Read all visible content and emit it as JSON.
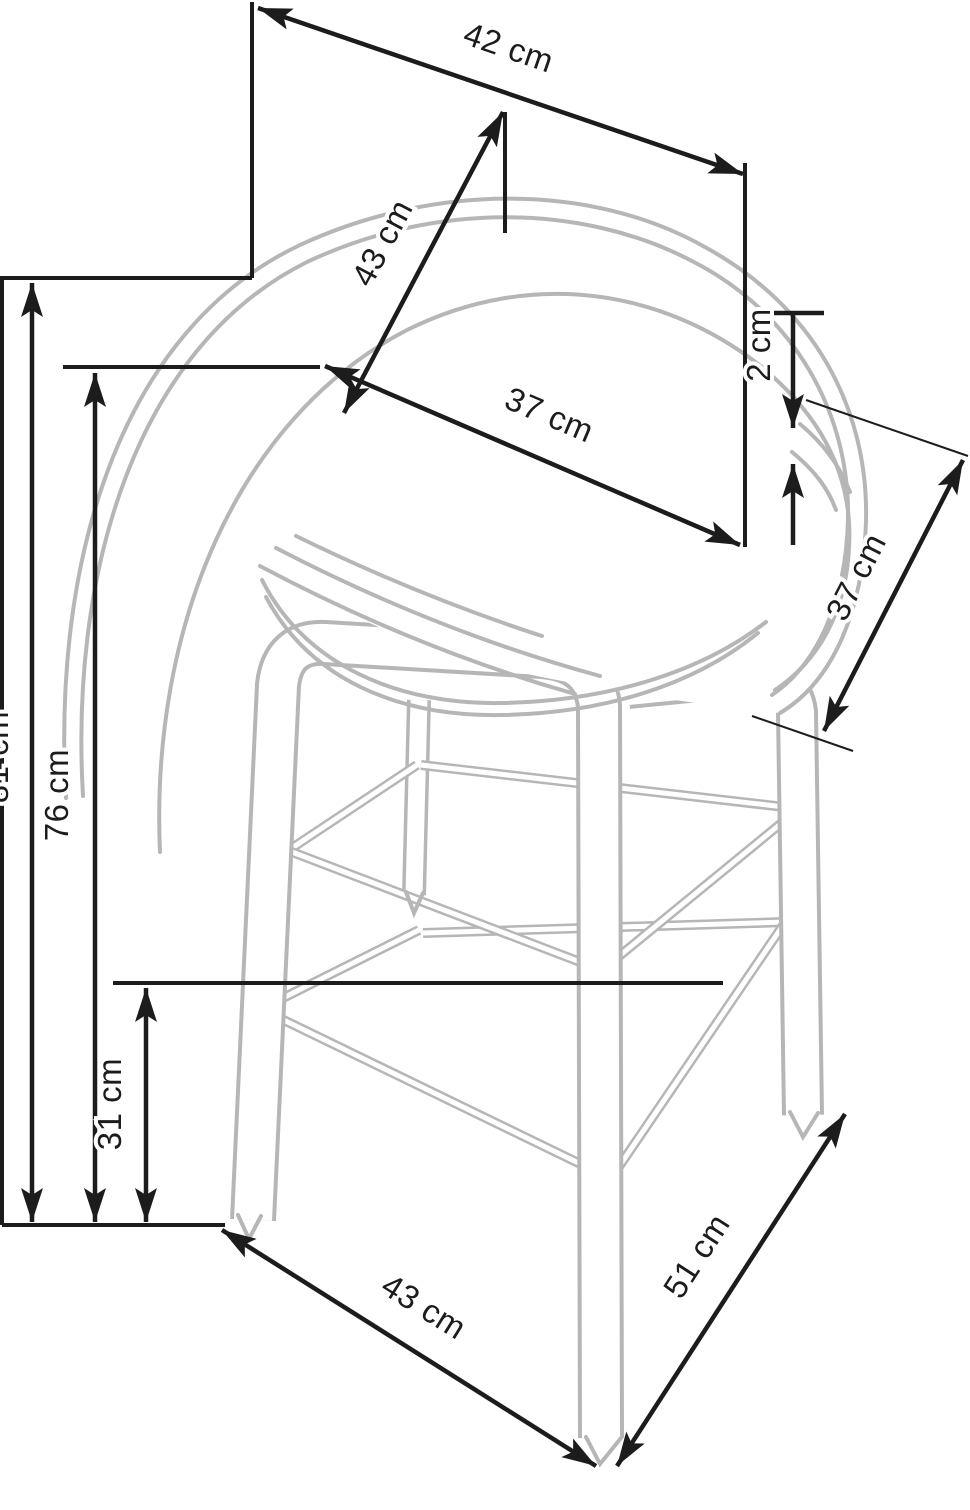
{
  "diagram": {
    "title": "bar stool dimension drawing",
    "unit": "cm",
    "colors": {
      "dimension_lines": "#1c1c1c",
      "stool_outline": "#b6b6b6",
      "background": "#ffffff",
      "label_halo": "#ffffff"
    },
    "dimensions": [
      {
        "id": "seat-top-width",
        "label": "42 cm",
        "value": 42
      },
      {
        "id": "backrest-diagonal",
        "label": "43 cm",
        "value": 43
      },
      {
        "id": "seat-inner-width",
        "label": "37 cm",
        "value": 37
      },
      {
        "id": "rim-thickness",
        "label": "2 cm",
        "value": 2
      },
      {
        "id": "backrest-height",
        "label": "37 cm",
        "value": 37
      },
      {
        "id": "total-height",
        "label": "81 cm",
        "value": 81
      },
      {
        "id": "seat-height",
        "label": "76 cm",
        "value": 76
      },
      {
        "id": "footrest-height",
        "label": "31 cm",
        "value": 31
      },
      {
        "id": "base-width",
        "label": "43 cm",
        "value": 43
      },
      {
        "id": "base-depth",
        "label": "51 cm",
        "value": 51
      }
    ]
  }
}
